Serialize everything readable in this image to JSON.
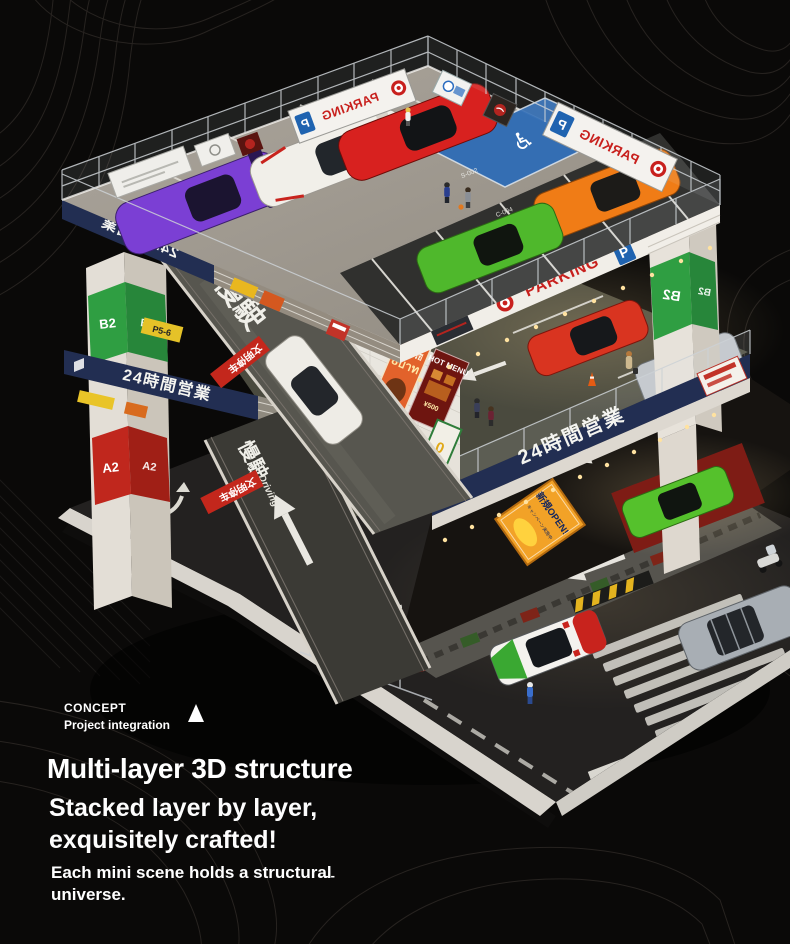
{
  "scene": {
    "background": "#0a0908",
    "contour_color": "#272320"
  },
  "colors": {
    "car_purple": "#7b3fd4",
    "car_white_racer": "#f1efe9",
    "car_red_ferrari": "#d8211f",
    "car_orange": "#f07c16",
    "car_green_top": "#4fb82c",
    "car_corvette_red": "#d93420",
    "car_silver_golf": "#c3c7cb",
    "car_green_lower": "#55c12c",
    "car_ramp_white": "#eeece6",
    "car_tricolor_body": "#f4f2ee",
    "car_suv_silver": "#a8aeb4",
    "banner_navy": "#222e52",
    "parking_red": "#c8201d",
    "parking_blue": "#1f63b0",
    "pillar_green": "#2f9e42",
    "pillar_red": "#c0271d",
    "open_banner_orange": "#f2a227"
  },
  "signs": {
    "parking": "PARKING",
    "p": "P",
    "hours": "24時間営業",
    "civilized": "文明停车",
    "slow": "慢駛",
    "driving": "Driving",
    "new_open": "新規OPEN!",
    "campaign": "キャンペーン実施中",
    "thai_name": "เทยโรยี",
    "thai_price": "8บาท",
    "hot_menu": "HOT MENU",
    "menu_price": "¥500",
    "floor2": "2/F",
    "floor1": "1/F",
    "b2": "B2",
    "a2": "A2",
    "yield": "礼让行人",
    "zone100": "100",
    "code_c": "C-004",
    "code_s": "S-002",
    "p56": "P5-6",
    "wheelchair": "♿"
  },
  "caption": {
    "eyebrow1": "CONCEPT",
    "eyebrow2": "Project integration",
    "title": "Multi-layer 3D structure",
    "subtitle1": "Stacked layer by layer,",
    "subtitle2": "exquisitely crafted!",
    "body1": "Each mini scene holds a structural",
    "body2": "universe.",
    "dashes": "---"
  }
}
